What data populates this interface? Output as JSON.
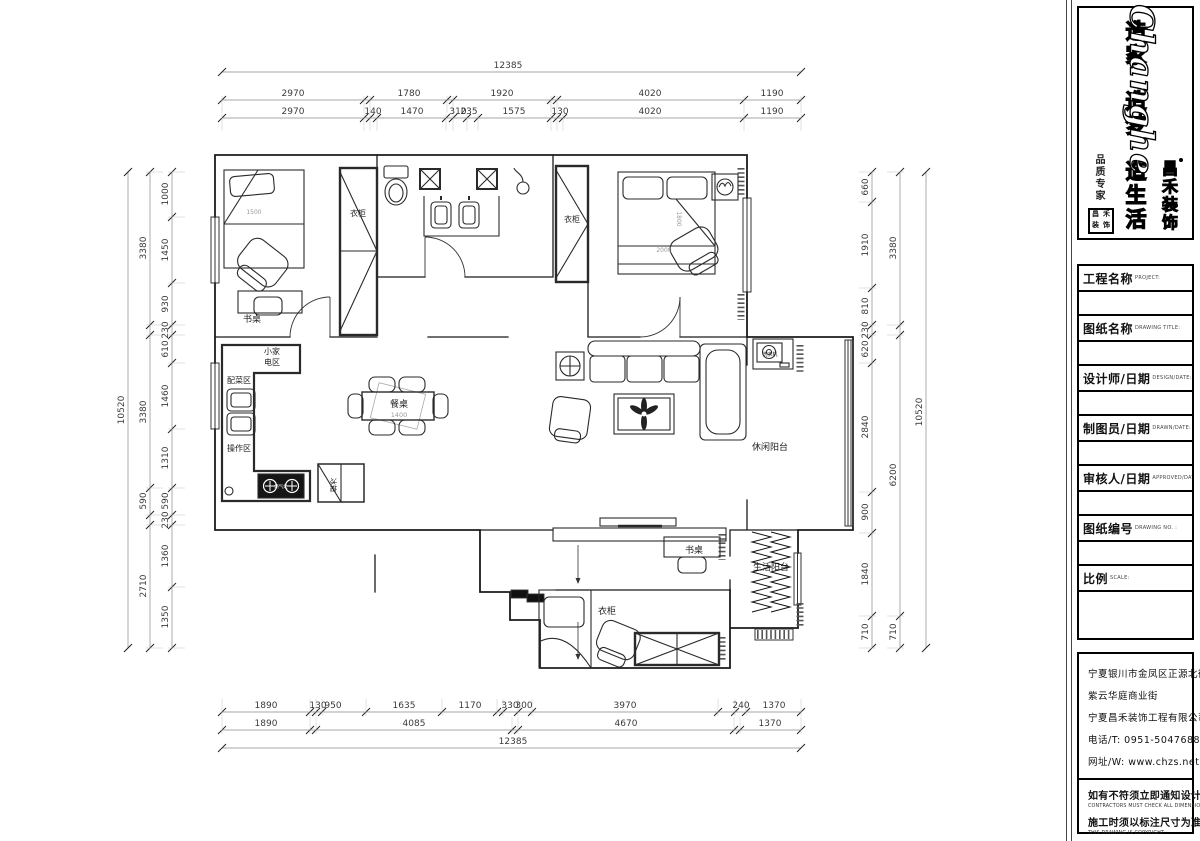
{
  "brand": {
    "logo_en": "Changhe",
    "logo_cn": "昌禾装饰",
    "slogans": [
      "造家",
      "造梦",
      "造生活"
    ],
    "slogan_small": "品质专家",
    "seal_chars": [
      "昌",
      "禾",
      "装",
      "饰"
    ]
  },
  "title_block": {
    "fields": [
      {
        "label": "工程名称",
        "sublabel": "PROJECT:",
        "value": ""
      },
      {
        "label": "图纸名称",
        "sublabel": "DRAWING TITLE:",
        "value": ""
      },
      {
        "label": "设计师/日期",
        "sublabel": "DESIGN/DATE:",
        "value": ""
      },
      {
        "label": "制图员/日期",
        "sublabel": "DRAWN/DATE:",
        "value": ""
      },
      {
        "label": "审核人/日期",
        "sublabel": "APPROVED/DATE:",
        "value": ""
      },
      {
        "label": "图纸编号",
        "sublabel": "DRAWING NO. :",
        "value": ""
      },
      {
        "label": "比例",
        "sublabel": "SCALE:",
        "value": ""
      }
    ]
  },
  "info_block": {
    "address_lines": [
      "宁夏银川市金凤区正源北街",
      "紫云华庭商业街",
      "宁夏昌禾装饰工程有限公司",
      "电话/T: 0951-5047688",
      "网址/W: www.chzs.net"
    ],
    "notes": [
      {
        "cn": "如有不符须立即通知设计人员",
        "en": "CONTRACTORS MUST CHECK ALL DIMENSIONS ON SITE"
      },
      {
        "cn": "施工时须以标注尺寸为准",
        "en": "THIS DRAWING IS COPYRIGHT"
      }
    ]
  },
  "plan_labels": [
    {
      "t": "衣柜",
      "x": 358,
      "y": 216,
      "s": 8
    },
    {
      "t": "书桌",
      "x": 252,
      "y": 322,
      "s": 9
    },
    {
      "t": "衣柜",
      "x": 572,
      "y": 222,
      "s": 8
    },
    {
      "t": "小家",
      "x": 272,
      "y": 354,
      "s": 8
    },
    {
      "t": "电区",
      "x": 272,
      "y": 365,
      "s": 8
    },
    {
      "t": "配菜区",
      "x": 239,
      "y": 383,
      "s": 8
    },
    {
      "t": "操作区",
      "x": 239,
      "y": 451,
      "s": 8
    },
    {
      "t": "餐桌",
      "x": 399,
      "y": 407,
      "s": 9
    },
    {
      "t": "1400",
      "x": 399,
      "y": 417,
      "s": 6.5,
      "c": "#999"
    },
    {
      "t": "休闲阳台",
      "x": 770,
      "y": 450,
      "s": 9
    },
    {
      "t": "洗衣机",
      "x": 770,
      "y": 356,
      "s": 5
    },
    {
      "t": "生活阳台",
      "x": 771,
      "y": 570,
      "s": 9
    },
    {
      "t": "书桌",
      "x": 694,
      "y": 553,
      "s": 9
    },
    {
      "t": "衣柜",
      "x": 607,
      "y": 614,
      "s": 9
    },
    {
      "t": "冰箱",
      "x": 331,
      "y": 485,
      "s": 7,
      "r": 90
    },
    {
      "t": "燃气灶",
      "x": 281,
      "y": 488,
      "s": 4.5,
      "c": "#fff"
    },
    {
      "t": "1500",
      "x": 254,
      "y": 214,
      "s": 6,
      "c": "#999"
    },
    {
      "t": "2000",
      "x": 664,
      "y": 252,
      "s": 6,
      "c": "#999"
    },
    {
      "t": "1800",
      "x": 677,
      "y": 219,
      "s": 6,
      "c": "#999",
      "r": 90
    }
  ],
  "dim_chains": [
    {
      "id": "top-total",
      "dir": "h",
      "y": 72,
      "x1": 222,
      "x2": 801,
      "ext": false,
      "ticks": [
        222,
        801
      ],
      "labels": [
        {
          "t": "12385",
          "p": 508
        }
      ]
    },
    {
      "id": "top-mid",
      "dir": "h",
      "y": 100,
      "x1": 222,
      "x2": 801,
      "ext": true,
      "extdir": 1,
      "ticks": [
        222,
        364,
        370,
        447,
        453,
        551,
        557,
        744,
        801
      ],
      "labels": [
        {
          "t": "2970",
          "p": 293
        },
        {
          "t": "1780",
          "p": 409
        },
        {
          "t": "1920",
          "p": 502
        },
        {
          "t": "4020",
          "p": 650
        },
        {
          "t": "1190",
          "p": 772
        }
      ]
    },
    {
      "id": "top-inner",
      "dir": "h",
      "y": 118,
      "x1": 222,
      "x2": 801,
      "ext": true,
      "extdir": 1,
      "ticks": [
        222,
        364,
        370,
        377,
        446,
        453,
        467,
        478,
        551,
        557,
        563,
        744,
        801
      ],
      "labels": [
        {
          "t": "2970",
          "p": 293
        },
        {
          "t": "140",
          "p": 373
        },
        {
          "t": "1470",
          "p": 412
        },
        {
          "t": "310",
          "p": 458
        },
        {
          "t": "235",
          "p": 469
        },
        {
          "t": "1575",
          "p": 514
        },
        {
          "t": "130",
          "p": 560
        },
        {
          "t": "4020",
          "p": 650
        },
        {
          "t": "1190",
          "p": 772
        }
      ]
    },
    {
      "id": "bottom-inner",
      "dir": "h",
      "y": 712,
      "x1": 222,
      "x2": 801,
      "ext": true,
      "extdir": -1,
      "ticks": [
        222,
        310,
        316,
        322,
        366,
        442,
        497,
        503,
        518,
        532,
        718,
        735,
        746,
        801
      ],
      "labels": [
        {
          "t": "1890",
          "p": 266
        },
        {
          "t": "130",
          "p": 318
        },
        {
          "t": "950",
          "p": 333
        },
        {
          "t": "1635",
          "p": 404
        },
        {
          "t": "1170",
          "p": 470
        },
        {
          "t": "330",
          "p": 510
        },
        {
          "t": "300",
          "p": 524
        },
        {
          "t": "3970",
          "p": 625
        },
        {
          "t": "240",
          "p": 741
        },
        {
          "t": "1370",
          "p": 774
        }
      ]
    },
    {
      "id": "bottom-mid",
      "dir": "h",
      "y": 730,
      "x1": 222,
      "x2": 801,
      "ext": true,
      "extdir": -1,
      "ticks": [
        222,
        310,
        316,
        512,
        518,
        734,
        740,
        801
      ],
      "labels": [
        {
          "t": "1890",
          "p": 266
        },
        {
          "t": "4085",
          "p": 414
        },
        {
          "t": "4670",
          "p": 626
        },
        {
          "t": "1370",
          "p": 770
        }
      ]
    },
    {
      "id": "bottom-total",
      "dir": "h",
      "y": 748,
      "x1": 222,
      "x2": 801,
      "ext": false,
      "ticks": [
        222,
        801
      ],
      "labels": [
        {
          "t": "12385",
          "p": 513
        }
      ]
    },
    {
      "id": "left-outer",
      "dir": "v",
      "x": 128,
      "y1": 172,
      "y2": 648,
      "ext": false,
      "ticks": [
        172,
        648
      ],
      "labels": [
        {
          "t": "10520",
          "p": 410
        }
      ]
    },
    {
      "id": "left-mid",
      "dir": "v",
      "x": 150,
      "y1": 172,
      "y2": 648,
      "ext": true,
      "extdir": 1,
      "ticks": [
        172,
        325,
        335,
        488,
        515,
        525,
        648
      ],
      "labels": [
        {
          "t": "3380",
          "p": 248
        },
        {
          "t": "3380",
          "p": 412
        },
        {
          "t": "590",
          "p": 501
        },
        {
          "t": "2710",
          "p": 586
        }
      ]
    },
    {
      "id": "left-inner",
      "dir": "v",
      "x": 172,
      "y1": 172,
      "y2": 648,
      "ext": true,
      "extdir": 1,
      "ticks": [
        172,
        217,
        283,
        325,
        335,
        363,
        429,
        488,
        515,
        525,
        587,
        648
      ],
      "labels": [
        {
          "t": "1000",
          "p": 194
        },
        {
          "t": "1450",
          "p": 250
        },
        {
          "t": "930",
          "p": 304
        },
        {
          "t": "230",
          "p": 330
        },
        {
          "t": "610",
          "p": 349
        },
        {
          "t": "1460",
          "p": 396
        },
        {
          "t": "1310",
          "p": 458
        },
        {
          "t": "590",
          "p": 501
        },
        {
          "t": "230",
          "p": 520
        },
        {
          "t": "1360",
          "p": 556
        },
        {
          "t": "1350",
          "p": 617
        }
      ]
    },
    {
      "id": "right-inner",
      "dir": "v",
      "x": 872,
      "y1": 172,
      "y2": 648,
      "ext": true,
      "extdir": -1,
      "ticks": [
        172,
        202,
        288,
        325,
        335,
        363,
        492,
        533,
        616,
        648
      ],
      "labels": [
        {
          "t": "660",
          "p": 187
        },
        {
          "t": "1910",
          "p": 245
        },
        {
          "t": "810",
          "p": 306
        },
        {
          "t": "230",
          "p": 330
        },
        {
          "t": "620",
          "p": 349
        },
        {
          "t": "2840",
          "p": 427
        },
        {
          "t": "900",
          "p": 512
        },
        {
          "t": "1840",
          "p": 574
        },
        {
          "t": "710",
          "p": 632
        }
      ]
    },
    {
      "id": "right-mid",
      "dir": "v",
      "x": 900,
      "y1": 172,
      "y2": 648,
      "ext": true,
      "extdir": -1,
      "ticks": [
        172,
        325,
        335,
        616,
        648
      ],
      "labels": [
        {
          "t": "3380",
          "p": 248
        },
        {
          "t": "6200",
          "p": 475
        },
        {
          "t": "710",
          "p": 632
        }
      ]
    },
    {
      "id": "right-outer",
      "dir": "v",
      "x": 926,
      "y1": 172,
      "y2": 648,
      "ext": false,
      "ticks": [
        172,
        648
      ],
      "labels": [
        {
          "t": "10520",
          "p": 412
        }
      ]
    }
  ]
}
